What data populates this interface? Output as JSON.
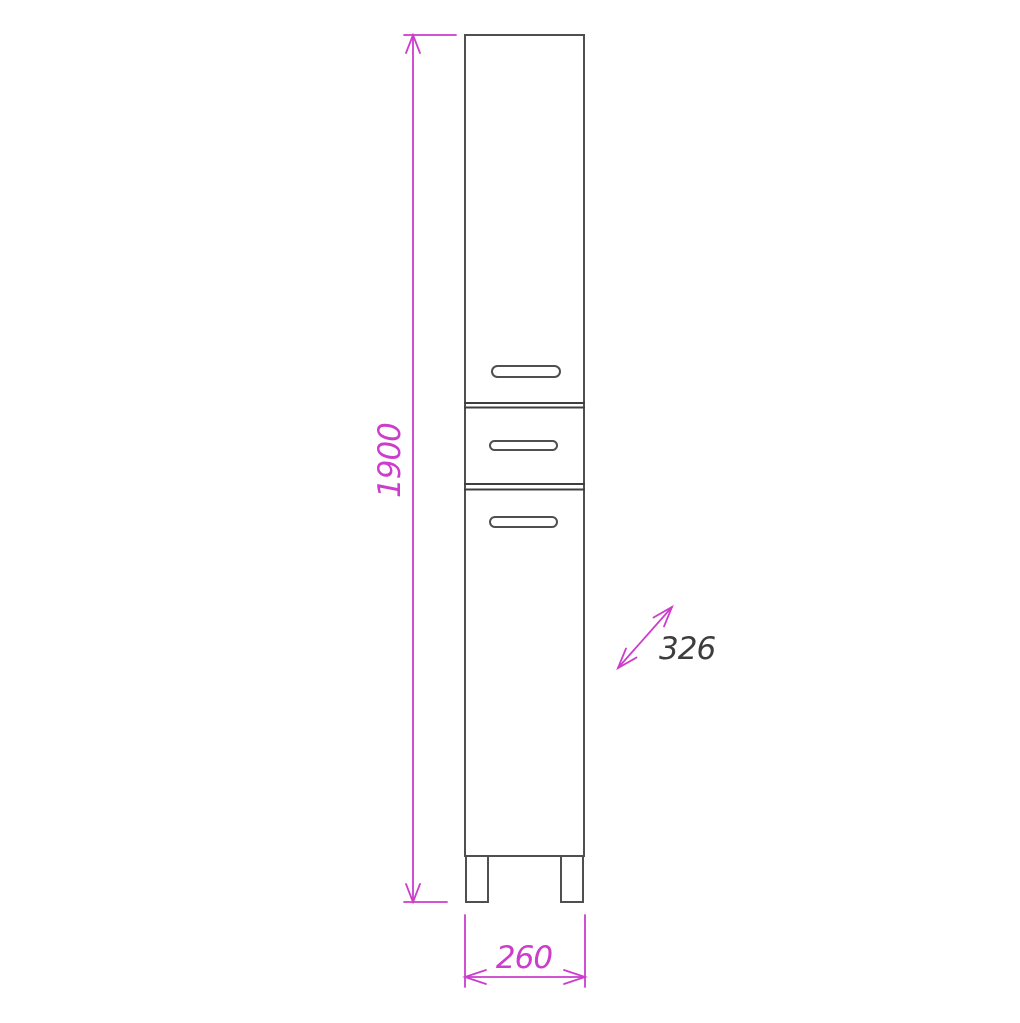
{
  "colors": {
    "outline": "#4f4f4f",
    "divider": "#3f3f3f",
    "dimension": "#cc3dcc",
    "depth_label": "#3d3d3d",
    "background": "#ffffff"
  },
  "dimensions": {
    "height": {
      "value": "1900"
    },
    "width": {
      "value": "260"
    },
    "depth": {
      "value": "326"
    }
  }
}
